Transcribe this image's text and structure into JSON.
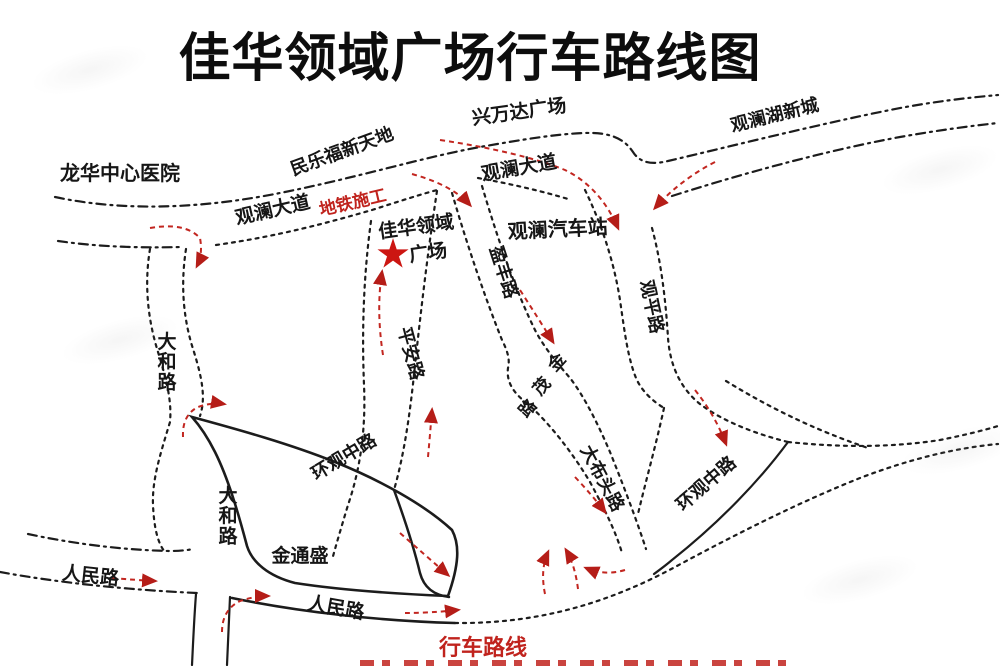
{
  "title": "佳华领域广场行车路线图",
  "map": {
    "route_color": "#c0231d",
    "road_color": "#1c1c1c",
    "legend": {
      "route_label": "行车路线"
    },
    "star_marker": "★",
    "labels": [
      {
        "name": "label-longhua-hospital",
        "text": "龙华中心医院",
        "x": 120,
        "y": 180,
        "rot": 0,
        "size": 20,
        "color": "#161616"
      },
      {
        "name": "label-minlefu-xintiandi",
        "text": "民乐福新天地",
        "x": 344,
        "y": 157,
        "rot": -20,
        "size": 18,
        "color": "#161616"
      },
      {
        "name": "label-guanlan-avenue-1",
        "text": "观澜大道",
        "x": 274,
        "y": 216,
        "rot": -13,
        "size": 19,
        "color": "#161616"
      },
      {
        "name": "label-subway-construction",
        "text": "地铁施工",
        "x": 354,
        "y": 208,
        "rot": -13,
        "size": 17,
        "color": "#c0231d"
      },
      {
        "name": "label-xingwanda-plaza",
        "text": "兴万达广场",
        "x": 520,
        "y": 118,
        "rot": -8,
        "size": 19,
        "color": "#161616"
      },
      {
        "name": "label-guanlan-avenue-2",
        "text": "观澜大道",
        "x": 520,
        "y": 174,
        "rot": -10,
        "size": 19,
        "color": "#161616"
      },
      {
        "name": "label-guanlanhu-new-town",
        "text": "观澜湖新城",
        "x": 776,
        "y": 121,
        "rot": -14,
        "size": 18,
        "color": "#161616"
      },
      {
        "name": "label-jiahua-lingyu-line1",
        "text": "佳华领域",
        "x": 417,
        "y": 233,
        "rot": -8,
        "size": 19,
        "color": "#161616"
      },
      {
        "name": "label-jiahua-lingyu-line2",
        "text": "广场",
        "x": 429,
        "y": 259,
        "rot": -8,
        "size": 19,
        "color": "#161616"
      },
      {
        "name": "plaza-star-marker",
        "text": "★",
        "x": 393,
        "y": 266,
        "rot": 0,
        "size": 36,
        "color": "#cc1612"
      },
      {
        "name": "label-guanlan-bus-station",
        "text": "观澜汽车站",
        "x": 558,
        "y": 236,
        "rot": -3,
        "size": 20,
        "color": "#161616"
      },
      {
        "name": "label-yingfeng-road",
        "text": "盈丰路",
        "x": 498,
        "y": 274,
        "rot": 72,
        "size": 18,
        "color": "#161616"
      },
      {
        "name": "label-guanping-road",
        "text": "观平路",
        "x": 646,
        "y": 308,
        "rot": 78,
        "size": 18,
        "color": "#161616"
      },
      {
        "name": "label-pingan-road",
        "text": "平安路",
        "x": 405,
        "y": 355,
        "rot": 75,
        "size": 18,
        "color": "#161616"
      },
      {
        "name": "label-dahe-road-1",
        "text": "大和路",
        "x": 167,
        "y": 348,
        "rot": 0,
        "size": 19,
        "color": "#161616",
        "vertical": true
      },
      {
        "name": "label-dahe-road-2",
        "text": "大和路",
        "x": 228,
        "y": 502,
        "rot": 0,
        "size": 19,
        "color": "#161616",
        "vertical": true
      },
      {
        "name": "label-jinmao-road",
        "text": "金茂路",
        "size": 17,
        "color": "#161616",
        "chars": [
          {
            "ch": "金",
            "x": 561,
            "y": 366,
            "rot": -48
          },
          {
            "ch": "茂",
            "x": 546,
            "y": 390,
            "rot": -48
          },
          {
            "ch": "路",
            "x": 532,
            "y": 412,
            "rot": -48
          }
        ]
      },
      {
        "name": "label-dabutou-road",
        "text": "大布头路",
        "x": 597,
        "y": 481,
        "rot": 62,
        "size": 18,
        "color": "#161616"
      },
      {
        "name": "label-huanguan-middle-road-1",
        "text": "环观中路",
        "x": 347,
        "y": 462,
        "rot": -31,
        "size": 18,
        "color": "#161616"
      },
      {
        "name": "label-huanguan-middle-road-2",
        "text": "环观中路",
        "x": 710,
        "y": 488,
        "rot": -41,
        "size": 18,
        "color": "#161616"
      },
      {
        "name": "label-jintongsheng",
        "text": "金通盛",
        "x": 300,
        "y": 562,
        "rot": 0,
        "size": 19,
        "color": "#161616"
      },
      {
        "name": "label-renmin-road-1",
        "text": "人民路",
        "x": 90,
        "y": 582,
        "rot": 6,
        "size": 19,
        "color": "#161616"
      },
      {
        "name": "label-renmin-road-2",
        "text": "人民路",
        "x": 335,
        "y": 614,
        "rot": 10,
        "size": 19,
        "color": "#161616"
      },
      {
        "name": "label-route-legend",
        "text": "行车路线",
        "x": 483,
        "y": 655,
        "rot": 0,
        "size": 22,
        "color": "#c0231d"
      }
    ]
  }
}
